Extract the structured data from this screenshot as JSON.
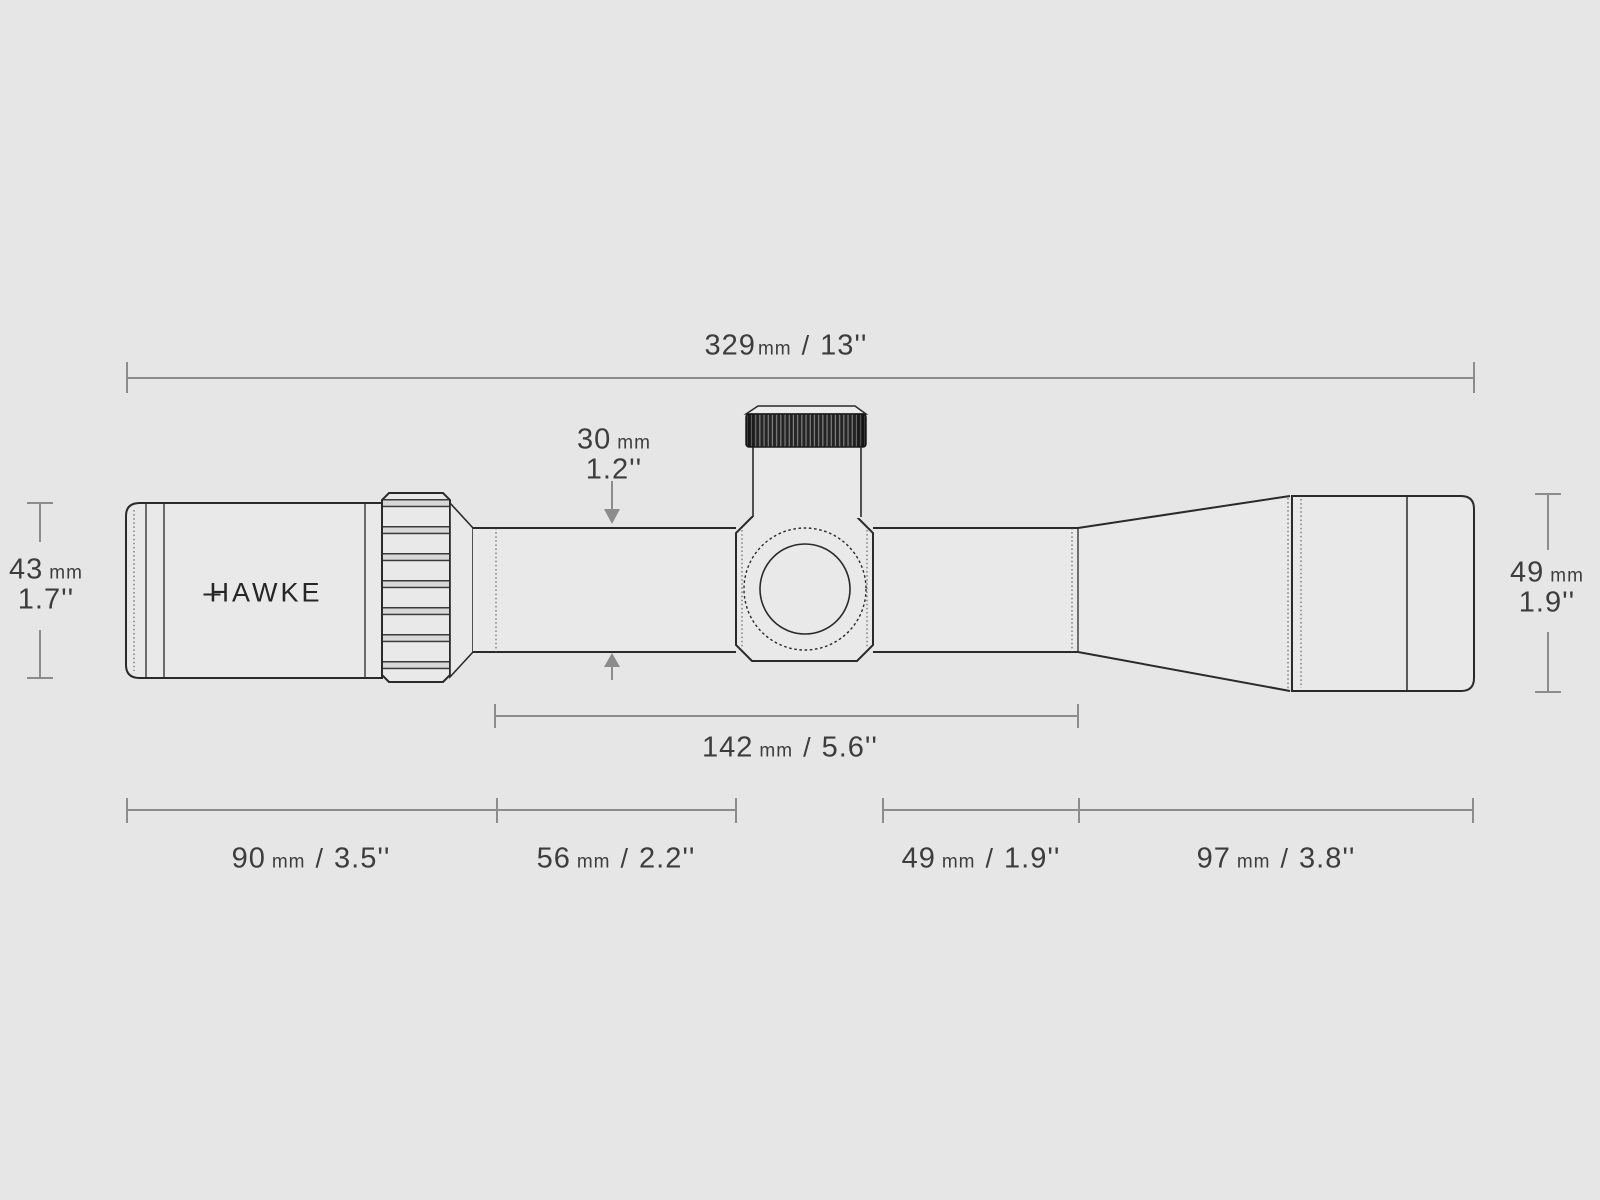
{
  "background": "#e6e6e6",
  "colors": {
    "outline": "#2a2a2a",
    "dimension_line": "#8c8c8c",
    "label_text": "#3d3d3d",
    "knurl_dark": "#242424"
  },
  "brand": {
    "logo": "HAWKE"
  },
  "dimensions": {
    "overall": {
      "value": "329",
      "unit": "mm",
      "separator": "/",
      "inches": "13''"
    },
    "tube_diameter": {
      "value": "30",
      "unit": "mm",
      "inches": "1.2''"
    },
    "ocular_diameter": {
      "value": "43",
      "unit": "mm",
      "inches": "1.7''"
    },
    "objective_diameter": {
      "value": "49",
      "unit": "mm",
      "inches": "1.9''"
    },
    "tube_length": {
      "value": "142",
      "unit": "mm",
      "separator": "/",
      "inches": "5.6''"
    },
    "ocular_section": {
      "value": "90",
      "unit": "mm",
      "separator": "/",
      "inches": "3.5''"
    },
    "tube_front_section": {
      "value": "56",
      "unit": "mm",
      "separator": "/",
      "inches": "2.2''"
    },
    "cone_section": {
      "value": "49",
      "unit": "mm",
      "separator": "/",
      "inches": "1.9''"
    },
    "bell_section": {
      "value": "97",
      "unit": "mm",
      "separator": "/",
      "inches": "3.8''"
    }
  }
}
